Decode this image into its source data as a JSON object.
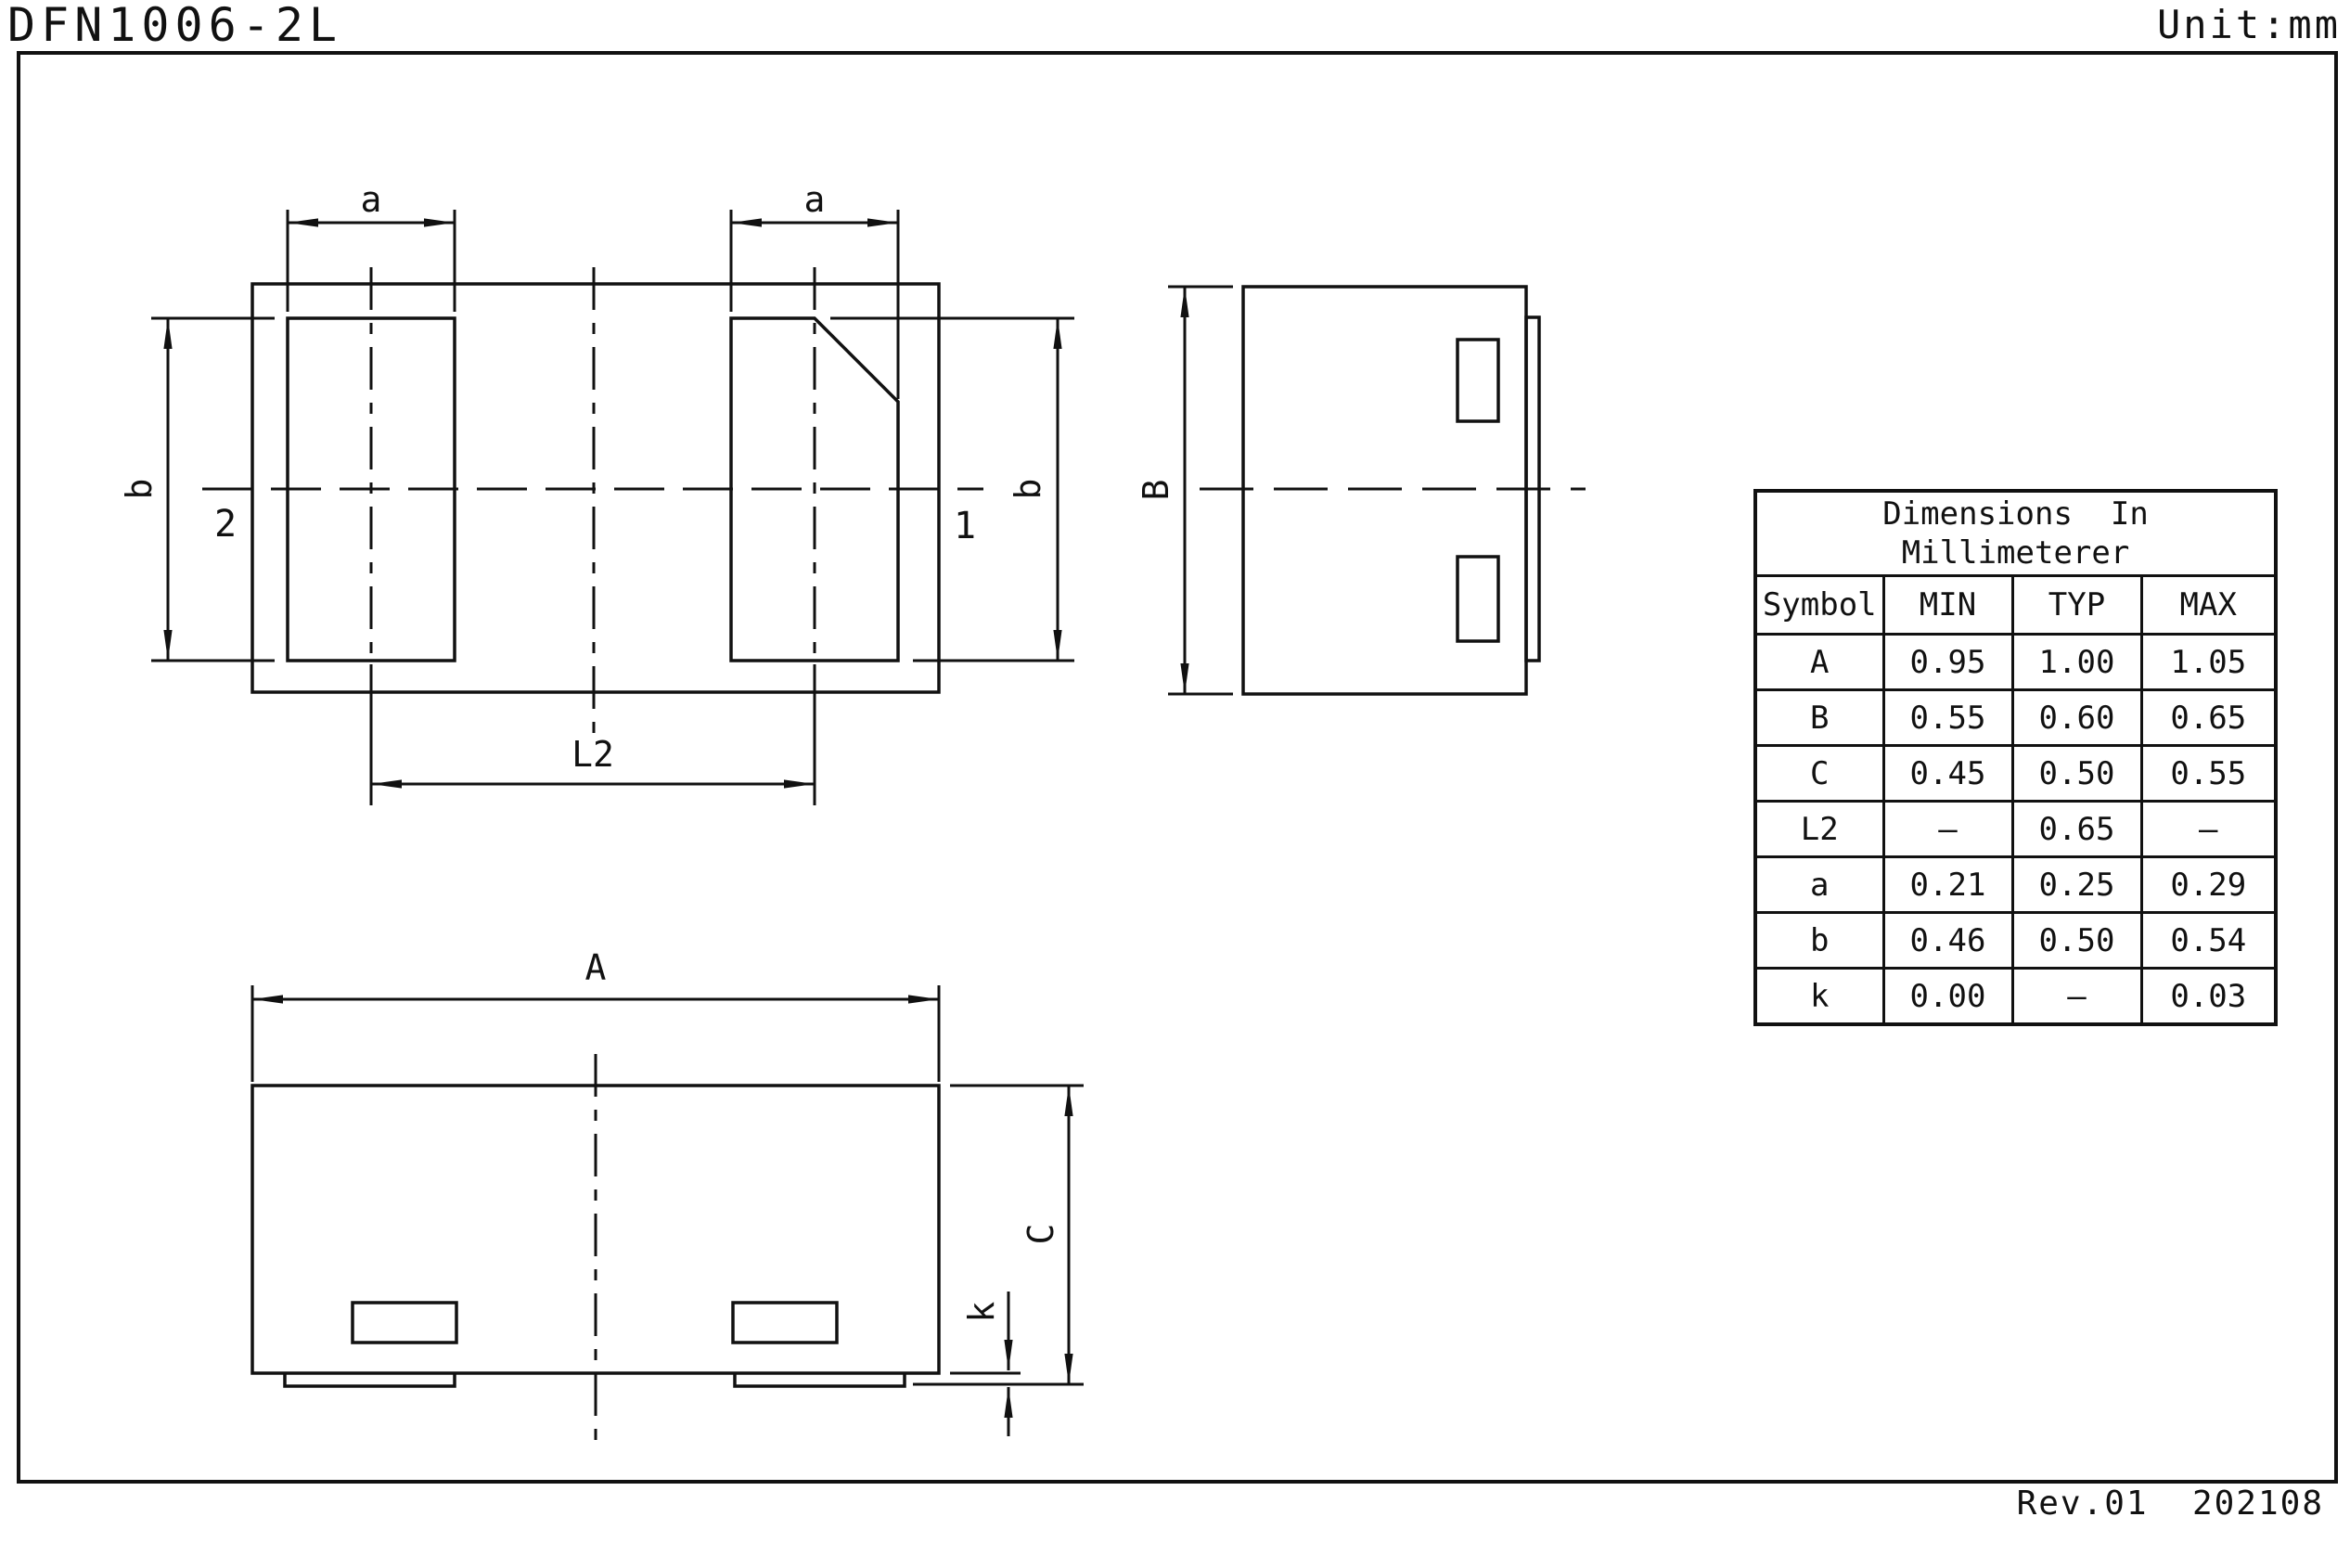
{
  "page": {
    "title": "DFN1006-2L",
    "unit": "Unit:mm",
    "footer": "Rev.01  202108"
  },
  "labels": {
    "a": "a",
    "b": "b",
    "A": "A",
    "B": "B",
    "C": "C",
    "k": "k",
    "L2": "L2",
    "pin1": "1",
    "pin2": "2"
  },
  "table": {
    "title_line1": "Dimensions  In",
    "title_line2": "Millimeterer",
    "headers": [
      "Symbol",
      "MIN",
      "TYP",
      "MAX"
    ],
    "rows": [
      [
        "A",
        "0.95",
        "1.00",
        "1.05"
      ],
      [
        "B",
        "0.55",
        "0.60",
        "0.65"
      ],
      [
        "C",
        "0.45",
        "0.50",
        "0.55"
      ],
      [
        "L2",
        "–",
        "0.65",
        "–"
      ],
      [
        "a",
        "0.21",
        "0.25",
        "0.29"
      ],
      [
        "b",
        "0.46",
        "0.50",
        "0.54"
      ],
      [
        "k",
        "0.00",
        "–",
        "0.03"
      ]
    ]
  }
}
